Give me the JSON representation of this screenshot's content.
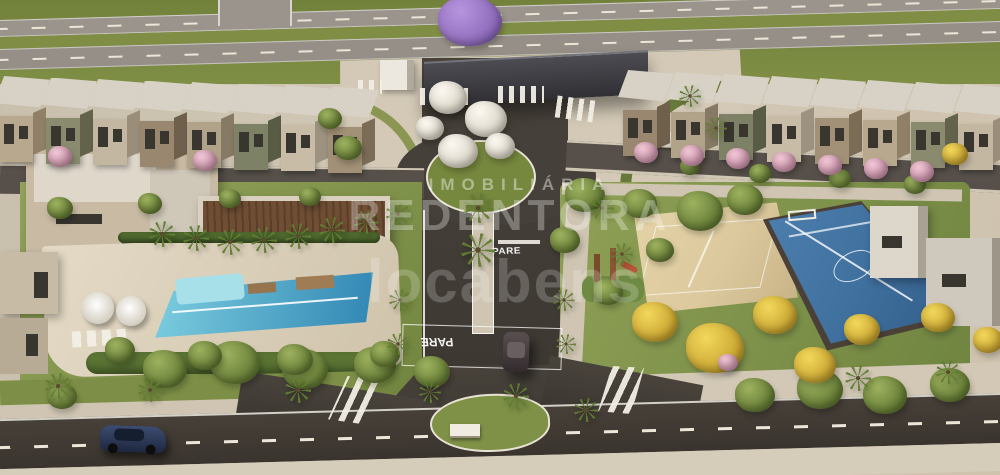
{
  "watermarks": {
    "line1": "IMOBILIÁRIA",
    "line2": "REDENTORA",
    "line3": "locabens"
  },
  "road_markings": {
    "stop_center": "PARE",
    "stop_south": "PARE"
  },
  "palette": {
    "pool_light": "#7fd0e0",
    "pool_deep": "#2e84b2",
    "court_blue": "#40719f",
    "sand": "#dcca9e",
    "grass": "#84954e",
    "asphalt": "#45403a",
    "pavement": "#cfc5b2",
    "canopy": "#3c3c40",
    "yellow_tree": "#e9c73f",
    "pink_tree": "#e3b2c4",
    "white_tree": "#f2eee6"
  }
}
